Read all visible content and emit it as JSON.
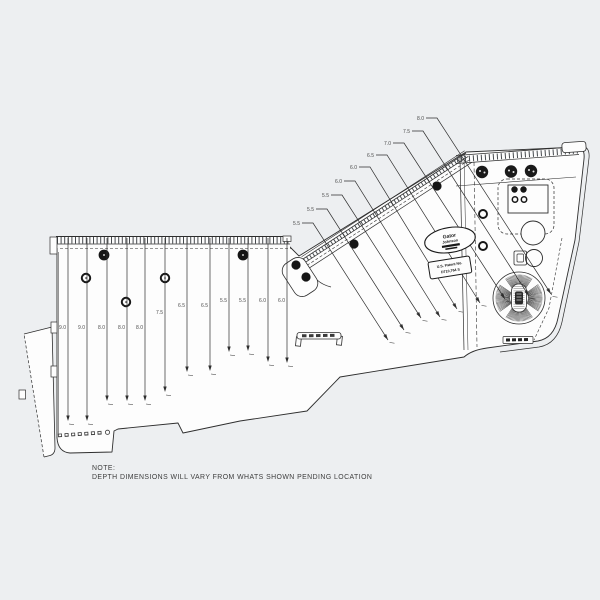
{
  "note": {
    "title": "NOTE:",
    "body": "DEPTH DIMENSIONS WILL VARY FROM WHATS SHOWN PENDING LOCATION"
  },
  "logo": {
    "line1": "Gator",
    "line2": "Johnson"
  },
  "patent": {
    "line1": "U.S. Patent No.",
    "line2": "D710,764 S"
  },
  "colors": {
    "background": "#edeff1",
    "deck": "#fdfdfd",
    "line": "#2e2e2e",
    "tread": "#45494d",
    "ink": "#151515"
  },
  "left_panel_callouts": [
    {
      "label": "9.0",
      "x": 68,
      "labelY": 327,
      "endY": 421
    },
    {
      "label": "9.0",
      "x": 87,
      "labelY": 327,
      "endY": 421
    },
    {
      "label": "8.0",
      "x": 107,
      "labelY": 327,
      "endY": 401
    },
    {
      "label": "8.0",
      "x": 127,
      "labelY": 327,
      "endY": 401
    },
    {
      "label": "8.0",
      "x": 145,
      "labelY": 327,
      "endY": 401
    },
    {
      "label": "7.5",
      "x": 165,
      "labelY": 312,
      "endY": 392
    },
    {
      "label": "6.5",
      "x": 187,
      "labelY": 305,
      "endY": 372
    },
    {
      "label": "6.5",
      "x": 210,
      "labelY": 305,
      "endY": 371
    },
    {
      "label": "5.5",
      "x": 229,
      "labelY": 300,
      "endY": 352
    },
    {
      "label": "5.5",
      "x": 248,
      "labelY": 300,
      "endY": 351
    },
    {
      "label": "6.0",
      "x": 268,
      "labelY": 300,
      "endY": 362
    },
    {
      "label": "6.0",
      "x": 287,
      "labelY": 300,
      "endY": 363
    }
  ],
  "diagonal_callouts": [
    {
      "label": "5.5",
      "lx": 300,
      "ly": 225,
      "ex": 388,
      "ey": 340
    },
    {
      "label": "5.5",
      "lx": 314,
      "ly": 211,
      "ex": 404,
      "ey": 330
    },
    {
      "label": "5.5",
      "lx": 329,
      "ly": 197,
      "ex": 421,
      "ey": 318
    },
    {
      "label": "6.0",
      "lx": 342,
      "ly": 183,
      "ex": 440,
      "ey": 317
    },
    {
      "label": "6.0",
      "lx": 357,
      "ly": 169,
      "ex": 457,
      "ey": 309
    },
    {
      "label": "6.5",
      "lx": 374,
      "ly": 157,
      "ex": 480,
      "ey": 303
    },
    {
      "label": "7.0",
      "lx": 391,
      "ly": 145,
      "ex": 505,
      "ey": 299
    },
    {
      "label": "7.5",
      "lx": 410,
      "ly": 133,
      "ex": 529,
      "ey": 296
    },
    {
      "label": "8.0",
      "lx": 424,
      "ly": 120,
      "ex": 551,
      "ey": 294
    }
  ]
}
